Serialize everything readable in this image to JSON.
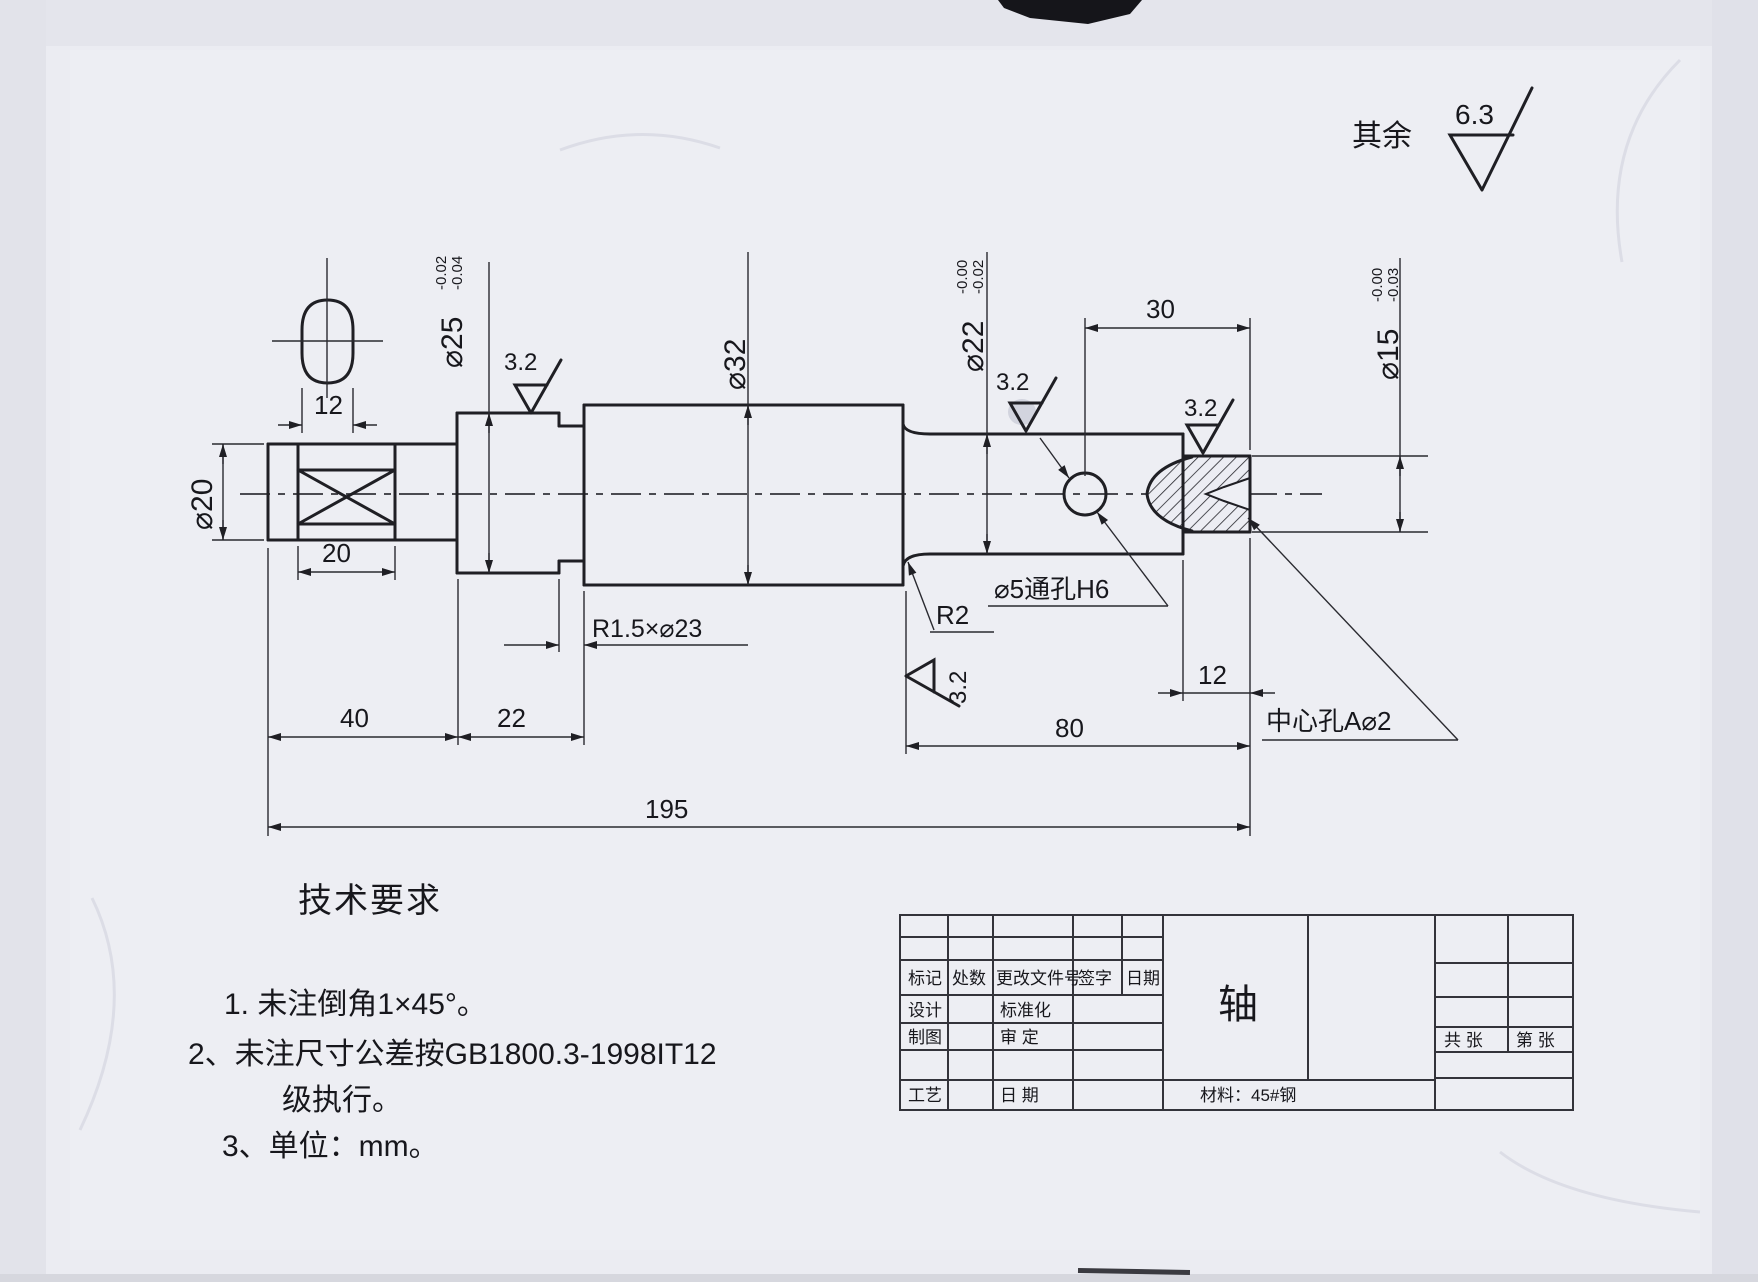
{
  "surface_note": {
    "prefix": "其余",
    "value": "6.3"
  },
  "section_view": {
    "width": "12"
  },
  "dims": {
    "d20": "⌀20",
    "d25": {
      "v": "⌀25",
      "tu": "-0.02",
      "tl": "-0.04"
    },
    "d32": "⌀32",
    "d22": {
      "v": "⌀22",
      "tu": "-0.00",
      "tl": "-0.02"
    },
    "d15": {
      "v": "⌀15",
      "tu": "-0.00",
      "tl": "-0.03"
    },
    "flat_len": "20",
    "seg1": "40",
    "seg2": "22",
    "seg3": "80",
    "total": "195",
    "end_len": "30",
    "end_step": "12",
    "groove": "R1.5×⌀23",
    "fillet": "R2",
    "through_hole": "⌀5通孔H6",
    "center_hole": "中心孔A⌀2",
    "roughness": "3.2"
  },
  "tech_req": {
    "title": "技术要求",
    "line1": "1. 未注倒角1×45°。",
    "line2a": "2、未注尺寸公差按GB1800.3-1998IT12",
    "line2b": "级执行。",
    "line3": "3、单位：mm。"
  },
  "title_block": {
    "rev": [
      "标记",
      "处数",
      "更改文件号",
      "签字",
      "日期"
    ],
    "design": "设计",
    "standard": "标准化",
    "draft": "制图",
    "approve": "审  定",
    "process": "工艺",
    "date": "日  期",
    "part": "轴",
    "total_sheets": "共 张",
    "sheet_no": "第 张",
    "material": "材料：45#钢"
  }
}
